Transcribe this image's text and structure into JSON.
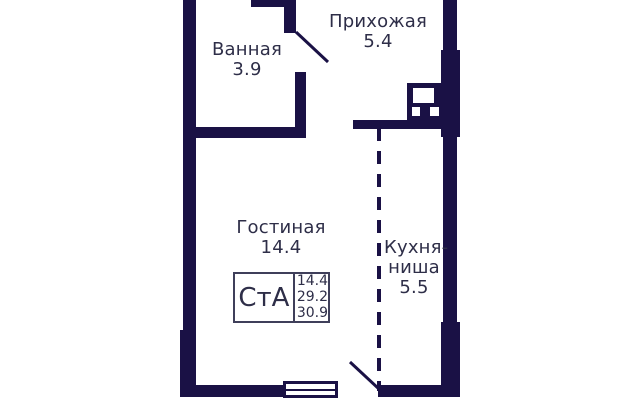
{
  "rooms": {
    "hallway": {
      "name": "Прихожая",
      "area": "5.4"
    },
    "bathroom": {
      "name": "Ванная",
      "area": "3.9"
    },
    "living_room": {
      "name": "Гостиная",
      "area": "14.4"
    },
    "kitchen_niche": {
      "name_line1": "Кухня-",
      "name_line2": "ниша",
      "area": "5.5"
    }
  },
  "stamp": {
    "label": "СтА",
    "values": [
      "14.4",
      "29.2",
      "30.9"
    ]
  },
  "colors": {
    "wall": "#1a1145",
    "text": "#2e2e48",
    "stamp_border": "#3f3f5a",
    "background": "#ffffff"
  }
}
